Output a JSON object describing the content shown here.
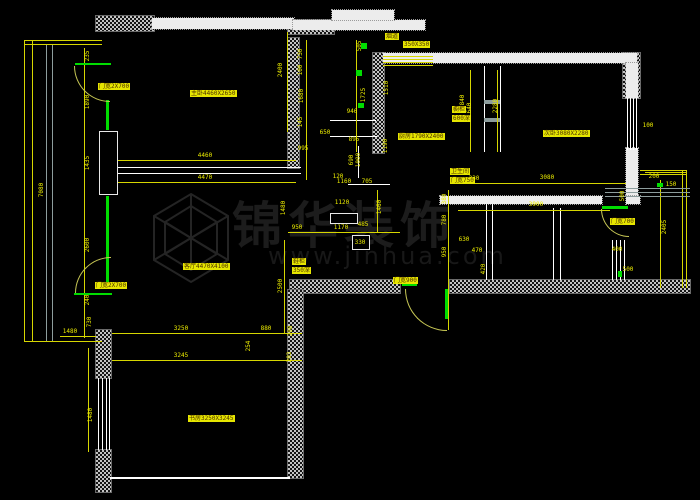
{
  "watermark": {
    "title": "锦华装饰",
    "url": "www.jinhua.com"
  },
  "colors": {
    "background": "#000000",
    "wall": "#ffffff",
    "dimension": "#ecec00",
    "highlight": "#e6e600",
    "green": "#00dd00"
  },
  "plan": {
    "rects": [
      [
        96,
        16,
        58,
        15,
        "hatch"
      ],
      [
        288,
        20,
        46,
        14,
        "hatch"
      ],
      [
        623,
        53,
        17,
        45,
        "hatch"
      ],
      [
        288,
        38,
        11,
        130,
        "hatch"
      ],
      [
        373,
        53,
        11,
        100,
        "hatch"
      ],
      [
        290,
        280,
        110,
        13,
        "hatch"
      ],
      [
        450,
        280,
        240,
        13,
        "hatch"
      ],
      [
        288,
        290,
        15,
        188,
        "hatch"
      ],
      [
        96,
        330,
        15,
        48,
        "hatch"
      ],
      [
        96,
        450,
        15,
        42,
        "hatch"
      ],
      [
        152,
        18,
        142,
        11,
        "band"
      ],
      [
        293,
        20,
        132,
        10,
        "band"
      ],
      [
        332,
        10,
        62,
        10,
        "band"
      ],
      [
        383,
        53,
        254,
        10,
        "band"
      ],
      [
        626,
        63,
        12,
        35,
        "band"
      ],
      [
        626,
        148,
        12,
        50,
        "band"
      ],
      [
        440,
        196,
        162,
        8,
        "band"
      ],
      [
        626,
        196,
        14,
        8,
        "band"
      ],
      [
        110,
        477,
        180,
        2,
        "wline"
      ],
      [
        115,
        167,
        186,
        1,
        "wline"
      ],
      [
        115,
        173,
        186,
        1,
        "wline"
      ],
      [
        484,
        66,
        1,
        86,
        "wline"
      ],
      [
        500,
        66,
        1,
        86,
        "wline"
      ],
      [
        484,
        100,
        16,
        4,
        "grayline"
      ],
      [
        484,
        118,
        16,
        4,
        "grayline"
      ],
      [
        330,
        120,
        46,
        1,
        "wline"
      ],
      [
        330,
        136,
        47,
        1,
        "wline"
      ],
      [
        358,
        146,
        1,
        32,
        "wline"
      ],
      [
        348,
        184,
        42,
        1,
        "wline"
      ],
      [
        98,
        378,
        1,
        72,
        "wline"
      ],
      [
        102,
        378,
        1,
        72,
        "wline"
      ],
      [
        106,
        378,
        1,
        72,
        "wline"
      ],
      [
        109,
        378,
        1,
        72,
        "wline"
      ],
      [
        627,
        98,
        1,
        52,
        "wline"
      ],
      [
        630,
        98,
        1,
        52,
        "wline"
      ],
      [
        633,
        98,
        1,
        52,
        "wline"
      ],
      [
        636,
        98,
        1,
        52,
        "wline"
      ],
      [
        553,
        208,
        1,
        72,
        "wline"
      ],
      [
        560,
        208,
        1,
        72,
        "wline"
      ],
      [
        612,
        240,
        1,
        40,
        "wline"
      ],
      [
        616,
        240,
        1,
        40,
        "wline"
      ],
      [
        620,
        240,
        1,
        40,
        "wline"
      ],
      [
        624,
        240,
        1,
        40,
        "wline"
      ],
      [
        486,
        204,
        1,
        76,
        "wline"
      ],
      [
        492,
        204,
        1,
        76,
        "wline"
      ],
      [
        99,
        131,
        17,
        62,
        "box"
      ],
      [
        330,
        213,
        26,
        9,
        "box"
      ],
      [
        352,
        235,
        16,
        13,
        "box"
      ],
      [
        24,
        40,
        1,
        302,
        "yline"
      ],
      [
        32,
        40,
        1,
        302,
        "yline"
      ],
      [
        24,
        40,
        78,
        1,
        "yline"
      ],
      [
        24,
        44,
        78,
        1,
        "yline"
      ],
      [
        24,
        341,
        78,
        1,
        "yline"
      ],
      [
        46,
        45,
        1,
        296,
        "grayline"
      ],
      [
        52,
        45,
        1,
        296,
        "grayline"
      ],
      [
        84,
        48,
        1,
        290,
        "yline"
      ],
      [
        118,
        160,
        178,
        1,
        "yline"
      ],
      [
        118,
        182,
        178,
        1,
        "yline"
      ],
      [
        287,
        32,
        1,
        100,
        "yline"
      ],
      [
        306,
        40,
        1,
        140,
        "yline"
      ],
      [
        356,
        40,
        1,
        112,
        "yline"
      ],
      [
        383,
        56,
        50,
        1,
        "yline"
      ],
      [
        383,
        59,
        50,
        1,
        "yline"
      ],
      [
        383,
        62,
        50,
        1,
        "yline"
      ],
      [
        383,
        65,
        50,
        1,
        "yline"
      ],
      [
        288,
        232,
        112,
        1,
        "yline"
      ],
      [
        112,
        333,
        190,
        1,
        "yline"
      ],
      [
        112,
        360,
        190,
        1,
        "yline"
      ],
      [
        284,
        240,
        1,
        93,
        "yline"
      ],
      [
        458,
        183,
        168,
        1,
        "yline"
      ],
      [
        458,
        210,
        152,
        1,
        "yline"
      ],
      [
        497,
        70,
        1,
        82,
        "yline"
      ],
      [
        470,
        70,
        1,
        82,
        "yline"
      ],
      [
        448,
        190,
        1,
        140,
        "yline"
      ],
      [
        660,
        180,
        1,
        108,
        "yline"
      ],
      [
        645,
        172,
        42,
        1,
        "yline"
      ],
      [
        377,
        190,
        1,
        42,
        "yline"
      ],
      [
        60,
        336,
        36,
        1,
        "yline"
      ],
      [
        88,
        348,
        1,
        104,
        "yline"
      ],
      [
        682,
        170,
        1,
        118,
        "yline"
      ],
      [
        686,
        170,
        1,
        118,
        "yline"
      ],
      [
        640,
        170,
        47,
        1,
        "yline"
      ],
      [
        640,
        174,
        47,
        1,
        "yline"
      ],
      [
        605,
        188,
        85,
        1,
        "grayline"
      ],
      [
        605,
        192,
        85,
        1,
        "grayline"
      ],
      [
        605,
        196,
        85,
        1,
        "grayline"
      ],
      [
        106,
        100,
        3,
        30,
        "gline"
      ],
      [
        106,
        196,
        3,
        88,
        "gline"
      ],
      [
        75,
        63,
        36,
        2,
        "gline"
      ],
      [
        74,
        293,
        38,
        2,
        "gline"
      ],
      [
        445,
        289,
        3,
        30,
        "gline"
      ],
      [
        402,
        284,
        15,
        2,
        "gline"
      ],
      [
        602,
        206,
        26,
        3,
        "gline"
      ],
      [
        356,
        70,
        6,
        6,
        "gline"
      ],
      [
        358,
        103,
        6,
        5,
        "gline"
      ],
      [
        361,
        43,
        6,
        6,
        "gline"
      ],
      [
        657,
        183,
        6,
        4,
        "gline"
      ],
      [
        618,
        271,
        4,
        6,
        "gline"
      ]
    ],
    "dims": [
      [
        "7080",
        42,
        190,
        1
      ],
      [
        "235",
        88,
        56,
        1
      ],
      [
        "1890",
        88,
        102,
        1
      ],
      [
        "1435",
        88,
        163,
        1
      ],
      [
        "2600",
        88,
        245,
        1
      ],
      [
        "240",
        88,
        300,
        1
      ],
      [
        "730",
        90,
        322,
        1
      ],
      [
        "1480",
        70,
        332,
        0
      ],
      [
        "1480",
        91,
        415,
        1
      ],
      [
        "4460",
        205,
        156,
        0
      ],
      [
        "4470",
        205,
        178,
        0
      ],
      [
        "2400",
        281,
        70,
        1
      ],
      [
        "1480",
        284,
        208,
        1
      ],
      [
        "950",
        297,
        228,
        0
      ],
      [
        "1170",
        341,
        228,
        0
      ],
      [
        "730",
        301,
        54,
        1
      ],
      [
        "100",
        301,
        70,
        1
      ],
      [
        "1680",
        302,
        96,
        1
      ],
      [
        "145",
        301,
        122,
        1
      ],
      [
        "505",
        360,
        46,
        1
      ],
      [
        "1725",
        364,
        95,
        1
      ],
      [
        "946",
        352,
        112,
        0
      ],
      [
        "895",
        354,
        140,
        0
      ],
      [
        "650",
        325,
        133,
        0
      ],
      [
        "995",
        303,
        149,
        0
      ],
      [
        "690",
        352,
        160,
        1
      ],
      [
        "1000",
        359,
        160,
        1
      ],
      [
        "120",
        338,
        177,
        0
      ],
      [
        "1160",
        344,
        182,
        0
      ],
      [
        "705",
        367,
        182,
        0
      ],
      [
        "1510",
        387,
        88,
        1
      ],
      [
        "1190",
        386,
        146,
        1
      ],
      [
        "1460",
        380,
        207,
        1
      ],
      [
        "1120",
        342,
        203,
        0
      ],
      [
        "485",
        363,
        225,
        0
      ],
      [
        "330",
        360,
        243,
        0
      ],
      [
        "2280",
        496,
        106,
        1
      ],
      [
        "640",
        470,
        108,
        1
      ],
      [
        "840",
        463,
        100,
        1
      ],
      [
        "3080",
        547,
        178,
        0
      ],
      [
        "230",
        474,
        179,
        0
      ],
      [
        "3900",
        536,
        205,
        0
      ],
      [
        "380",
        445,
        199,
        1
      ],
      [
        "780",
        445,
        220,
        1
      ],
      [
        "950",
        445,
        252,
        1
      ],
      [
        "630",
        464,
        240,
        0
      ],
      [
        "470",
        477,
        251,
        0
      ],
      [
        "420",
        484,
        269,
        1
      ],
      [
        "2405",
        665,
        227,
        1
      ],
      [
        "200",
        654,
        177,
        0
      ],
      [
        "150",
        671,
        185,
        0
      ],
      [
        "500",
        623,
        196,
        1
      ],
      [
        "100",
        648,
        126,
        0
      ],
      [
        "400",
        617,
        250,
        0
      ],
      [
        "500",
        628,
        270,
        0
      ],
      [
        "2500",
        281,
        286,
        1
      ],
      [
        "880",
        266,
        329,
        0
      ],
      [
        "208",
        291,
        331,
        1
      ],
      [
        "3250",
        181,
        329,
        0
      ],
      [
        "3245",
        181,
        356,
        0
      ],
      [
        "254",
        249,
        346,
        1
      ],
      [
        "203",
        290,
        357,
        1
      ]
    ],
    "labels": [
      [
        98,
        83,
        "门宽2X700"
      ],
      [
        95,
        282,
        "门宽2X700"
      ],
      [
        393,
        277,
        "门宽900"
      ],
      [
        610,
        218,
        "门宽700"
      ],
      [
        190,
        90,
        "主卧4460X2650"
      ],
      [
        398,
        133,
        "厨房1790X2400"
      ],
      [
        543,
        130,
        "次卧3080X2280"
      ],
      [
        183,
        263,
        "客厅4470X4100"
      ],
      [
        188,
        415,
        "书房3250X3245"
      ],
      [
        452,
        106,
        "橱柜"
      ],
      [
        452,
        115,
        "600深"
      ],
      [
        450,
        168,
        "卫生间"
      ],
      [
        450,
        177,
        "门宽750"
      ],
      [
        385,
        33,
        "烟道"
      ],
      [
        403,
        41,
        "350X350"
      ],
      [
        292,
        258,
        "鞋柜"
      ],
      [
        292,
        267,
        "350深"
      ]
    ],
    "arcs": [
      [
        74,
        66,
        35,
        35,
        "bl"
      ],
      [
        75,
        257,
        35,
        35,
        "tl"
      ],
      [
        405,
        289,
        41,
        41,
        "bl"
      ],
      [
        601,
        209,
        27,
        27,
        "bl"
      ]
    ]
  }
}
